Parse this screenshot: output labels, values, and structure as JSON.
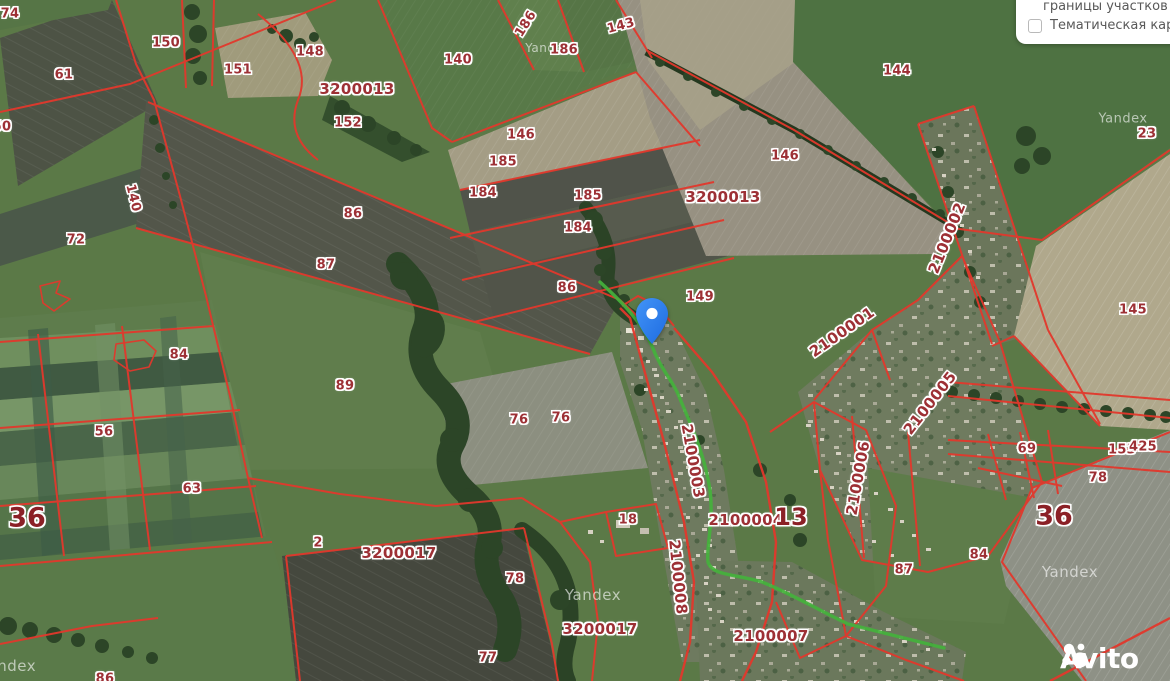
{
  "panel": {
    "option1": "границы участков",
    "option2": "Тематическая карта",
    "option2_checked": false
  },
  "logo": {
    "text": "Avito"
  },
  "map": {
    "watermark_text": "Yandex",
    "watermarks": [
      {
        "x": 1123,
        "y": 119,
        "s": 13
      },
      {
        "x": 1070,
        "y": 572,
        "s": 15
      },
      {
        "x": 593,
        "y": 595,
        "s": 15
      },
      {
        "x": 8,
        "y": 666,
        "s": 15
      },
      {
        "x": 548,
        "y": 48,
        "s": 12
      }
    ],
    "pin": {
      "x": 652,
      "y": 344
    },
    "colors": {
      "boundary_red": "#e2382c",
      "label_red": "#9d3035",
      "label_strong_red": "#8b2026",
      "road_green": "#44b23c",
      "pin_blue": "#2f7ef2"
    },
    "labels": [
      {
        "t": "74",
        "x": 10,
        "y": 14,
        "s": 13,
        "r": 0
      },
      {
        "t": "150",
        "x": 166,
        "y": 43,
        "s": 13,
        "r": 0
      },
      {
        "t": "151",
        "x": 238,
        "y": 70,
        "s": 13,
        "r": 0
      },
      {
        "t": "148",
        "x": 310,
        "y": 52,
        "s": 13,
        "r": 0
      },
      {
        "t": "61",
        "x": 64,
        "y": 75,
        "s": 13,
        "r": 0
      },
      {
        "t": "50",
        "x": 2,
        "y": 127,
        "s": 13,
        "r": 0
      },
      {
        "t": "140",
        "x": 133,
        "y": 198,
        "s": 13,
        "r": 76
      },
      {
        "t": "72",
        "x": 76,
        "y": 240,
        "s": 13,
        "r": 0
      },
      {
        "t": "3200013",
        "x": 357,
        "y": 89,
        "s": 15,
        "r": 0
      },
      {
        "t": "152",
        "x": 348,
        "y": 123,
        "s": 13,
        "r": 0
      },
      {
        "t": "140",
        "x": 458,
        "y": 60,
        "s": 13,
        "r": 0
      },
      {
        "t": "186",
        "x": 526,
        "y": 24,
        "s": 13,
        "r": -58
      },
      {
        "t": "186",
        "x": 564,
        "y": 50,
        "s": 13,
        "r": 0
      },
      {
        "t": "143",
        "x": 621,
        "y": 26,
        "s": 13,
        "r": -15
      },
      {
        "t": "146",
        "x": 521,
        "y": 135,
        "s": 13,
        "r": 0
      },
      {
        "t": "185",
        "x": 503,
        "y": 162,
        "s": 13,
        "r": 0
      },
      {
        "t": "184",
        "x": 483,
        "y": 193,
        "s": 13,
        "r": 0
      },
      {
        "t": "185",
        "x": 588,
        "y": 196,
        "s": 13,
        "r": 0
      },
      {
        "t": "184",
        "x": 578,
        "y": 228,
        "s": 13,
        "r": 0
      },
      {
        "t": "86",
        "x": 353,
        "y": 214,
        "s": 13,
        "r": 0
      },
      {
        "t": "87",
        "x": 326,
        "y": 265,
        "s": 13,
        "r": 0
      },
      {
        "t": "86",
        "x": 567,
        "y": 288,
        "s": 13,
        "r": 0
      },
      {
        "t": "89",
        "x": 345,
        "y": 386,
        "s": 13,
        "r": 0
      },
      {
        "t": "84",
        "x": 179,
        "y": 355,
        "s": 13,
        "r": 0
      },
      {
        "t": "56",
        "x": 104,
        "y": 432,
        "s": 13,
        "r": 0
      },
      {
        "t": "63",
        "x": 192,
        "y": 489,
        "s": 13,
        "r": 0
      },
      {
        "t": "2",
        "x": 318,
        "y": 543,
        "s": 13,
        "r": 0
      },
      {
        "t": "76",
        "x": 519,
        "y": 420,
        "s": 13,
        "r": 0
      },
      {
        "t": "76",
        "x": 561,
        "y": 418,
        "s": 13,
        "r": 0
      },
      {
        "t": "3200017",
        "x": 399,
        "y": 553,
        "s": 15,
        "r": 0
      },
      {
        "t": "78",
        "x": 515,
        "y": 579,
        "s": 13,
        "r": 0
      },
      {
        "t": "77",
        "x": 488,
        "y": 658,
        "s": 13,
        "r": 0
      },
      {
        "t": "3200017",
        "x": 600,
        "y": 629,
        "s": 15,
        "r": 0
      },
      {
        "t": "18",
        "x": 628,
        "y": 520,
        "s": 13,
        "r": 0
      },
      {
        "t": "2100004",
        "x": 746,
        "y": 520,
        "s": 15,
        "r": 0
      },
      {
        "t": "13",
        "x": 791,
        "y": 517,
        "s": 24,
        "r": 0,
        "w": 1
      },
      {
        "t": "2100003",
        "x": 693,
        "y": 461,
        "s": 15,
        "r": 80
      },
      {
        "t": "2100008",
        "x": 678,
        "y": 577,
        "s": 15,
        "r": 84
      },
      {
        "t": "2100007",
        "x": 771,
        "y": 636,
        "s": 15,
        "r": 0
      },
      {
        "t": "2100001",
        "x": 842,
        "y": 332,
        "s": 15,
        "r": -35
      },
      {
        "t": "2100002",
        "x": 947,
        "y": 238,
        "s": 15,
        "r": -68
      },
      {
        "t": "2100005",
        "x": 930,
        "y": 403,
        "s": 15,
        "r": -52
      },
      {
        "t": "2100006",
        "x": 858,
        "y": 478,
        "s": 15,
        "r": -80
      },
      {
        "t": "149",
        "x": 700,
        "y": 297,
        "s": 13,
        "r": 0
      },
      {
        "t": "3200013",
        "x": 723,
        "y": 197,
        "s": 15,
        "r": 0
      },
      {
        "t": "146",
        "x": 785,
        "y": 156,
        "s": 13,
        "r": 0
      },
      {
        "t": "144",
        "x": 897,
        "y": 71,
        "s": 13,
        "r": 0
      },
      {
        "t": "23",
        "x": 1147,
        "y": 134,
        "s": 13,
        "r": 0
      },
      {
        "t": "145",
        "x": 1133,
        "y": 310,
        "s": 13,
        "r": 0
      },
      {
        "t": "69",
        "x": 1027,
        "y": 449,
        "s": 13,
        "r": 0
      },
      {
        "t": "153",
        "x": 1122,
        "y": 450,
        "s": 13,
        "r": 0
      },
      {
        "t": "425",
        "x": 1143,
        "y": 447,
        "s": 13,
        "r": 0
      },
      {
        "t": "78",
        "x": 1098,
        "y": 478,
        "s": 13,
        "r": 0
      },
      {
        "t": "84",
        "x": 979,
        "y": 555,
        "s": 13,
        "r": 0
      },
      {
        "t": "87",
        "x": 904,
        "y": 570,
        "s": 13,
        "r": 0
      },
      {
        "t": "36",
        "x": 27,
        "y": 518,
        "s": 27,
        "r": 0,
        "w": 1
      },
      {
        "t": "36",
        "x": 1054,
        "y": 516,
        "s": 27,
        "r": 0,
        "w": 1
      },
      {
        "t": "86",
        "x": 105,
        "y": 679,
        "s": 13,
        "r": 0
      }
    ]
  }
}
